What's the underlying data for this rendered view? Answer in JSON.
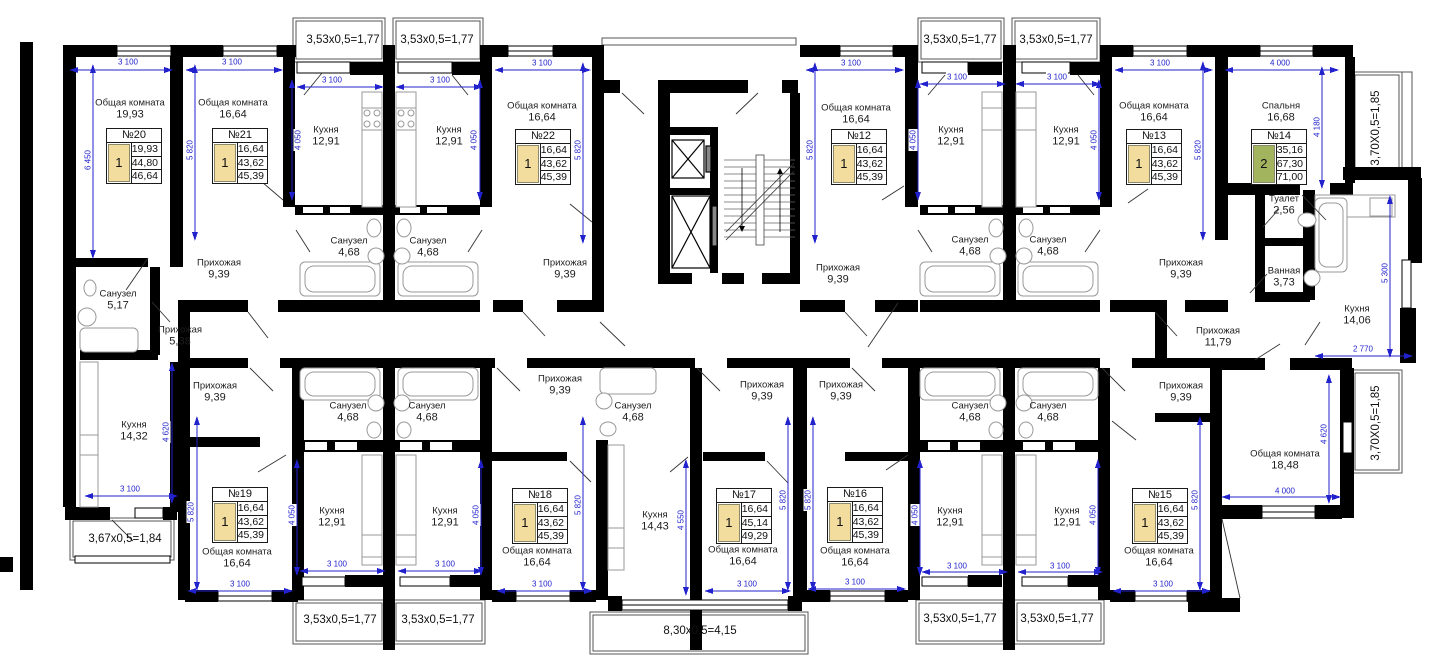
{
  "colors": {
    "wall": "#000000",
    "dimension_blue": "#2222cc",
    "card_yellow": "#f2dd9e",
    "card_green": "#a2b45e"
  },
  "cards": [
    {
      "label": "№20",
      "rooms": "1",
      "values": [
        "19,93",
        "44,80",
        "46,64"
      ]
    },
    {
      "label": "№21",
      "rooms": "1",
      "values": [
        "16,64",
        "43,62",
        "45,39"
      ]
    },
    {
      "label": "№22",
      "rooms": "1",
      "values": [
        "16,64",
        "43,62",
        "45,39"
      ]
    },
    {
      "label": "№12",
      "rooms": "1",
      "values": [
        "16,64",
        "43,62",
        "45,39"
      ]
    },
    {
      "label": "№13",
      "rooms": "1",
      "values": [
        "16,64",
        "43,62",
        "45,39"
      ]
    },
    {
      "label": "№14",
      "rooms": "2",
      "values": [
        "35,16",
        "67,30",
        "71,00"
      ]
    },
    {
      "label": "№19",
      "rooms": "1",
      "values": [
        "16,64",
        "43,62",
        "45,39"
      ]
    },
    {
      "label": "№18",
      "rooms": "1",
      "values": [
        "16,64",
        "43,62",
        "45,39"
      ]
    },
    {
      "label": "№17",
      "rooms": "1",
      "values": [
        "16,64",
        "45,14",
        "49,29"
      ]
    },
    {
      "label": "№16",
      "rooms": "1",
      "values": [
        "16,64",
        "43,62",
        "45,39"
      ]
    },
    {
      "label": "№15",
      "rooms": "1",
      "values": [
        "16,64",
        "43,62",
        "45,39"
      ]
    }
  ],
  "rooms": [
    {
      "name": "Общая комната",
      "area": "19,93"
    },
    {
      "name": "Общая комната",
      "area": "16,64"
    },
    {
      "name": "Прихожая",
      "area": "9,39"
    },
    {
      "name": "Кухня",
      "area": "12,91"
    },
    {
      "name": "Кухня",
      "area": "12,91"
    },
    {
      "name": "Санузел",
      "area": "4,68"
    },
    {
      "name": "Санузел",
      "area": "4,68"
    },
    {
      "name": "Общая комната",
      "area": "16,64"
    },
    {
      "name": "Прихожая",
      "area": "9,39"
    },
    {
      "name": "Общая комната",
      "area": "16,64"
    },
    {
      "name": "Прихожая",
      "area": "9,39"
    },
    {
      "name": "Кухня",
      "area": "12,91"
    },
    {
      "name": "Кухня",
      "area": "12,91"
    },
    {
      "name": "Санузел",
      "area": "4,68"
    },
    {
      "name": "Санузел",
      "area": "4,68"
    },
    {
      "name": "Общая комната",
      "area": "16,64"
    },
    {
      "name": "Прихожая",
      "area": "9,39"
    },
    {
      "name": "Спальня",
      "area": "16,68"
    },
    {
      "name": "Туалет",
      "area": "2,56"
    },
    {
      "name": "Ванная",
      "area": "3,73"
    },
    {
      "name": "Кухня",
      "area": "14,06"
    },
    {
      "name": "Прихожая",
      "area": "11,79"
    },
    {
      "name": "Санузел",
      "area": "5,17"
    },
    {
      "name": "Прихожая",
      "area": "5,38"
    },
    {
      "name": "Кухня",
      "area": "14,32"
    },
    {
      "name": "Прихожая",
      "area": "9,39"
    },
    {
      "name": "Общая комната",
      "area": "16,64"
    },
    {
      "name": "Санузел",
      "area": "4,68"
    },
    {
      "name": "Санузел",
      "area": "4,68"
    },
    {
      "name": "Кухня",
      "area": "12,91"
    },
    {
      "name": "Кухня",
      "area": "12,91"
    },
    {
      "name": "Прихожая",
      "area": "9,39"
    },
    {
      "name": "Санузел",
      "area": "4,68"
    },
    {
      "name": "Кухня",
      "area": "14,43"
    },
    {
      "name": "Общая комната",
      "area": "16,64"
    },
    {
      "name": "Прихожая",
      "area": "9,39"
    },
    {
      "name": "Общая комната",
      "area": "16,64"
    },
    {
      "name": "Прихожая",
      "area": "9,39"
    },
    {
      "name": "Общая комната",
      "area": "16,64"
    },
    {
      "name": "Санузел",
      "area": "4,68"
    },
    {
      "name": "Санузел",
      "area": "4,68"
    },
    {
      "name": "Кухня",
      "area": "12,91"
    },
    {
      "name": "Кухня",
      "area": "12,91"
    },
    {
      "name": "Прихожая",
      "area": "9,39"
    },
    {
      "name": "Общая комната",
      "area": "16,64"
    },
    {
      "name": "Общая комната",
      "area": "18,48"
    }
  ],
  "dims": [
    {
      "t": "3 100"
    },
    {
      "t": "3 100"
    },
    {
      "t": "3 100"
    },
    {
      "t": "3 100"
    },
    {
      "t": "3 100"
    },
    {
      "t": "3 100"
    },
    {
      "t": "3 100"
    },
    {
      "t": "3 100"
    },
    {
      "t": "3 100"
    },
    {
      "t": "4 000"
    },
    {
      "t": "6 450"
    },
    {
      "t": "5 820"
    },
    {
      "t": "4 050"
    },
    {
      "t": "4 050"
    },
    {
      "t": "5 820"
    },
    {
      "t": "5 820"
    },
    {
      "t": "4 050"
    },
    {
      "t": "4 050"
    },
    {
      "t": "5 820"
    },
    {
      "t": "4 180"
    },
    {
      "t": "5 300"
    },
    {
      "t": "2 770"
    },
    {
      "t": "4 620"
    },
    {
      "t": "3 100"
    },
    {
      "t": "5 820"
    },
    {
      "t": "4 050"
    },
    {
      "t": "3 100"
    },
    {
      "t": "3 100"
    },
    {
      "t": "3 100"
    },
    {
      "t": "4 050"
    },
    {
      "t": "5 820"
    },
    {
      "t": "3 100"
    },
    {
      "t": "4 550"
    },
    {
      "t": "3 100"
    },
    {
      "t": "5 820"
    },
    {
      "t": "5 820"
    },
    {
      "t": "3 100"
    },
    {
      "t": "4 050"
    },
    {
      "t": "3 100"
    },
    {
      "t": "3 100"
    },
    {
      "t": "4 050"
    },
    {
      "t": "5 820"
    },
    {
      "t": "3 100"
    },
    {
      "t": "4 000"
    },
    {
      "t": "4 620"
    }
  ],
  "balconies": [
    {
      "t": "3,53x0,5=1,77"
    },
    {
      "t": "3,53x0,5=1,77"
    },
    {
      "t": "3,53x0,5=1,77"
    },
    {
      "t": "3,53x0,5=1,77"
    },
    {
      "t": "3,70X0,5=1,85"
    },
    {
      "t": "3,67x0,5=1,84"
    },
    {
      "t": "3,53x0,5=1,77"
    },
    {
      "t": "3,53x0,5=1,77"
    },
    {
      "t": "8,30x0,5=4,15"
    },
    {
      "t": "3,53x0,5=1,77"
    },
    {
      "t": "3,53x0,5=1,77"
    },
    {
      "t": "3,70X0,5=1,85"
    }
  ]
}
